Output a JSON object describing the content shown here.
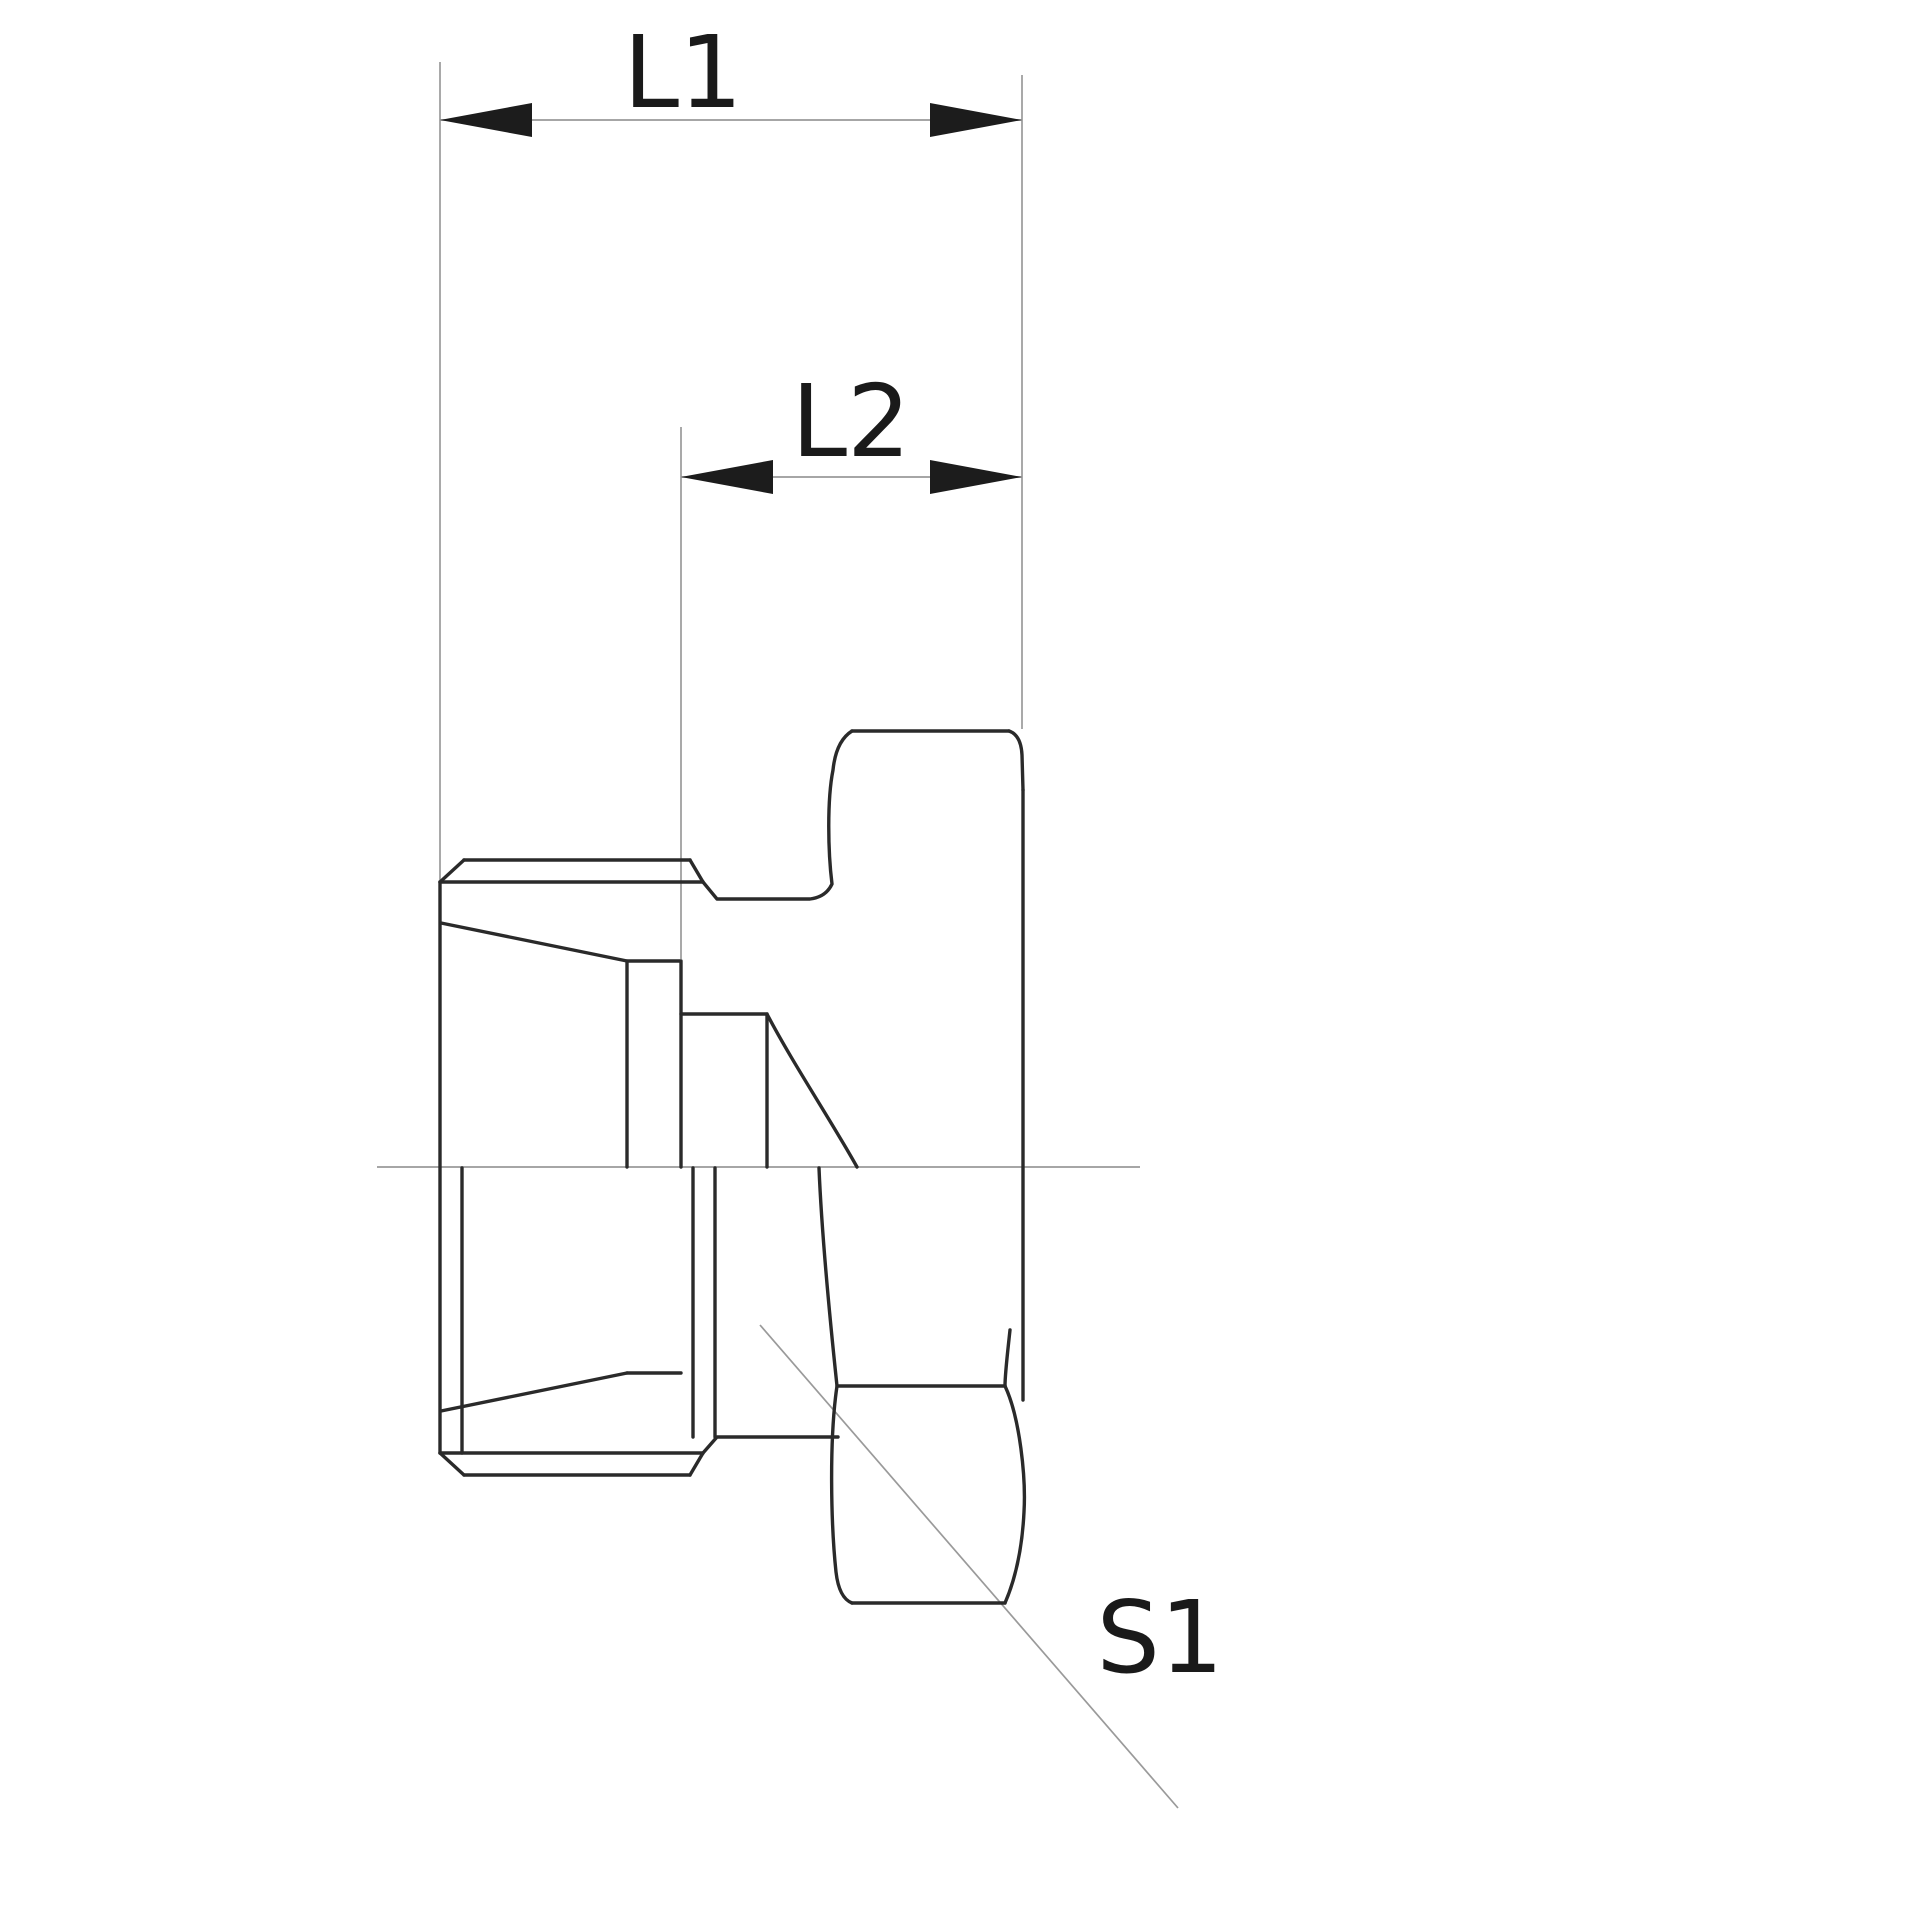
{
  "drawing": {
    "type": "engineering-dimension-drawing",
    "labels": {
      "dim_overall_length": "L1",
      "dim_partial_length": "L2",
      "wrench_size": "S1"
    },
    "colors": {
      "background": "#ffffff",
      "outline": "#2a2a2a",
      "thin_line": "#9a9a9a",
      "arrow_fill": "#1c1c1c",
      "text": "#1a1a1a"
    }
  }
}
